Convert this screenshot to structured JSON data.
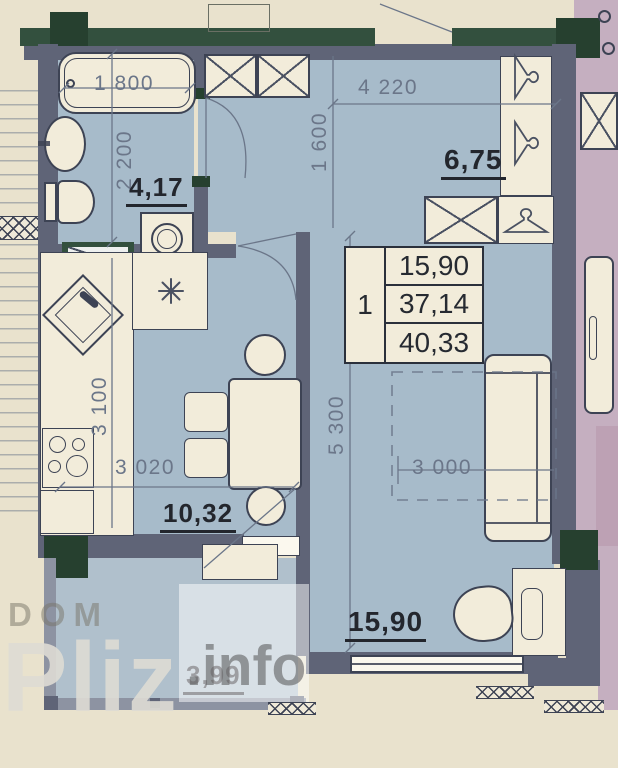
{
  "colors": {
    "page_bg": "#e9e2cd",
    "room_blue": "#a7bbca",
    "balcony_blue": "#b0c0cc",
    "wall_gray": "#5f6477",
    "wall_light": "#8d93a2",
    "wall_green": "#33503e",
    "wall_green_dark": "#26402f",
    "furniture_cream": "#f2ecda",
    "line_dark": "#3d4354",
    "dim_gray": "#6b7689",
    "label_dark": "#23262d",
    "neighbor_pink": "#c5afc0",
    "neighbor_pink_dark": "#bda1b4",
    "watermark_light": "rgba(222,220,212,0.9)",
    "watermark_mid": "rgba(120,115,103,0.5)",
    "watermark_dark": "rgba(95,95,97,0.6)"
  },
  "plan": {
    "dims": {
      "bathtub_width": "1 800",
      "bathroom_depth": "2 200",
      "hallway_width": "4 220",
      "hallway_depth": "1 600",
      "kitchen_depth": "3 100",
      "kitchen_width": "3 020",
      "living_depth": "5 300",
      "living_width": "3 000"
    },
    "areas": {
      "bathroom": "4,17",
      "hallway": "6,75",
      "kitchen": "10,32",
      "living": "15,90",
      "balcony": "3,99"
    },
    "info_table": {
      "unit_number": "1",
      "living_area": "15,90",
      "apartment_area": "37,14",
      "total_area": "40,33"
    },
    "icons": {
      "burner_star": "✳",
      "coat_hanger": "coat-hanger",
      "wardrobe_x": "crossed-box"
    }
  },
  "watermark": {
    "line1": "DOM",
    "brand": "Pliz",
    "suffix": ".info"
  }
}
